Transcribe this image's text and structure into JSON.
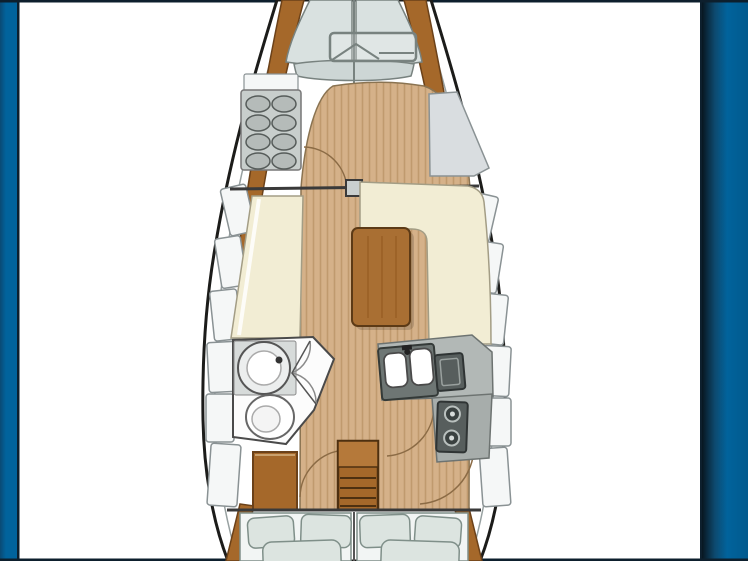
{
  "meta": {
    "description": "Top-down interior floor plan drawing of a sailing yacht, bow pointing up, framed by blue page-background strips on the left and right edges",
    "orientation": "bow-up"
  },
  "colors": {
    "page_bg": "#ffffff",
    "side_strip_blue": "#01639c",
    "side_strip_dark": "#0a2740",
    "frame_line": "#0d1f2d",
    "hull_outline": "#1c1c1a",
    "inner_deck_line": "#98a1a1",
    "rail_brown": "#a5682a",
    "rail_shadow": "#6b4119",
    "deck_grey": "#d9e1e0",
    "deck_band": "#cdd6d5",
    "deck_line": "#78827f",
    "teak": "#d5b189",
    "teak_stripe": "#c09a6e",
    "teak_line": "#8a7351",
    "cream": "#f2edd4",
    "cream_line": "#a39d85",
    "table_brown": "#a96f33",
    "table_line": "#5c3a16",
    "table_grain": "#93591f",
    "locker_fill": "#f5f7f7",
    "locker_line": "#8a9294",
    "unit_grey": "#c8cecc",
    "oval_grey": "#b5bbb9",
    "oval_line": "#565c5a",
    "counter_grey": "#6e7674",
    "counter_light": "#b2b8b6",
    "appliance_dark": "#575e5d",
    "appliance_line": "#2f3434",
    "burner_ring": "#b9c0be",
    "cushion": "#dce4e0",
    "cushion_line": "#7f8f89",
    "arc_line": "#8b6b45",
    "wall_line": "#3a3a3a",
    "white_fixture": "#fcfcfc",
    "fixture_line": "#555555",
    "step_light": "#b5793a",
    "step_line": "#4e3010"
  },
  "regions": [
    {
      "id": "foredeck",
      "label": "foredeck-with-anchor-hatch"
    },
    {
      "id": "forward-cabin",
      "label": "forward-cabin-with-shelf-unit-and-seat"
    },
    {
      "id": "saloon",
      "label": "saloon-with-settees-and-table"
    },
    {
      "id": "head",
      "label": "head-with-sink-and-toilet"
    },
    {
      "id": "galley",
      "label": "galley-with-sink-icebox-stove"
    },
    {
      "id": "companionway",
      "label": "companionway-steps"
    },
    {
      "id": "aft-cabin",
      "label": "aft-double-berths"
    }
  ],
  "components": {
    "left_hull_lockers": [
      [
        225,
        186,
        26,
        48,
        -13
      ],
      [
        218,
        237,
        26,
        50,
        -9
      ],
      [
        212,
        290,
        27,
        50,
        -6
      ],
      [
        208,
        342,
        28,
        50,
        -3
      ],
      [
        206,
        394,
        28,
        48,
        0
      ],
      [
        209,
        444,
        30,
        62,
        4
      ]
    ],
    "right_hull_lockers": [
      [
        468,
        194,
        26,
        46,
        13
      ],
      [
        474,
        242,
        26,
        50,
        9
      ],
      [
        479,
        294,
        27,
        50,
        6
      ],
      [
        482,
        346,
        28,
        50,
        3
      ],
      [
        483,
        398,
        28,
        48,
        0
      ],
      [
        481,
        448,
        28,
        58,
        -4
      ]
    ],
    "shelf_unit": {
      "x": 241,
      "y": 90,
      "w": 60,
      "h": 80,
      "oval_cols": [
        258,
        284
      ],
      "oval_rows": [
        104,
        123,
        142,
        161
      ],
      "oval_rx": 12,
      "oval_ry": 8
    },
    "pillows": [
      [
        248,
        517,
        46,
        30,
        -4
      ],
      [
        301,
        515,
        50,
        32,
        2
      ],
      [
        360,
        515,
        50,
        32,
        -2
      ],
      [
        415,
        517,
        46,
        30,
        4
      ]
    ],
    "mattresses": [
      [
        263,
        541,
        78,
        34,
        -2
      ],
      [
        381,
        541,
        78,
        34,
        2
      ]
    ],
    "burners": [
      [
        452,
        414
      ],
      [
        452,
        438
      ]
    ],
    "sink_basins": [
      [
        385,
        352,
        22,
        34,
        0
      ],
      [
        411,
        350,
        22,
        36,
        0
      ]
    ],
    "table": {
      "x": 352,
      "y": 228,
      "w": 58,
      "h": 98,
      "grain_xs": [
        368,
        382,
        396
      ]
    }
  }
}
